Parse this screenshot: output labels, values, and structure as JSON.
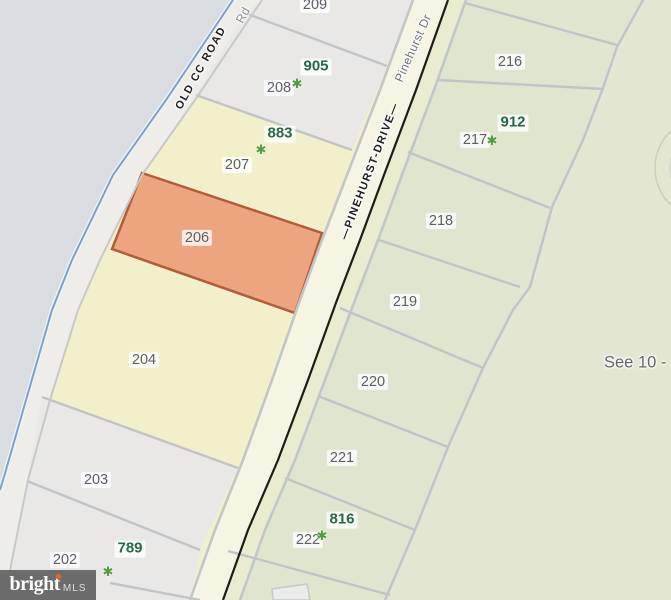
{
  "watermark": {
    "brand": "bright",
    "suffix": "MLS"
  },
  "annotation": {
    "see_note": "See 10 -"
  },
  "streets": {
    "old_cc_road": {
      "label": "OLD CC ROAD",
      "secondary": "Rd"
    },
    "pinehurst": {
      "label": "—PINEHURST-DRIVE—",
      "secondary": "Pinehurst Dr"
    }
  },
  "icons": {
    "tree": "✱"
  },
  "parcels": [
    {
      "number": "209",
      "selected": false
    },
    {
      "number": "208",
      "selected": false
    },
    {
      "number": "207",
      "selected": false
    },
    {
      "number": "206",
      "selected": true
    },
    {
      "number": "204",
      "selected": false
    },
    {
      "number": "203",
      "selected": false
    },
    {
      "number": "202",
      "selected": false
    },
    {
      "number": "216",
      "selected": false
    },
    {
      "number": "217",
      "selected": false
    },
    {
      "number": "218",
      "selected": false
    },
    {
      "number": "219",
      "selected": false
    },
    {
      "number": "220",
      "selected": false
    },
    {
      "number": "221",
      "selected": false
    },
    {
      "number": "222",
      "selected": false
    }
  ],
  "listings": [
    {
      "address": "905",
      "parcel": "208"
    },
    {
      "address": "883",
      "parcel": "207"
    },
    {
      "address": "912",
      "parcel": "217"
    },
    {
      "address": "789",
      "parcel": "202"
    },
    {
      "address": "816",
      "parcel": "222"
    }
  ],
  "colors": {
    "water": "#d9dde2",
    "parcel_neutral": "#eae8e6",
    "parcel_yellow": "#f2f0ca",
    "parcel_green": "#e0e5cd",
    "parcel_green_light": "#e3e7d1",
    "highlight_fill": "#eda57f",
    "highlight_stroke": "#b45b37",
    "road_fill": "#f6f5e3",
    "road_fill_green": "#e9ecce",
    "boundary": "#c0c4c6",
    "centerline": "#1d1d16",
    "shore_blue": "#7da0c8",
    "label_gray": "#5b5f66",
    "listing_green": "#26694a",
    "tree_green": "#4f9e3c",
    "watermark_bg": "#6c6c6c",
    "watermark_accent": "#d96a2b"
  }
}
